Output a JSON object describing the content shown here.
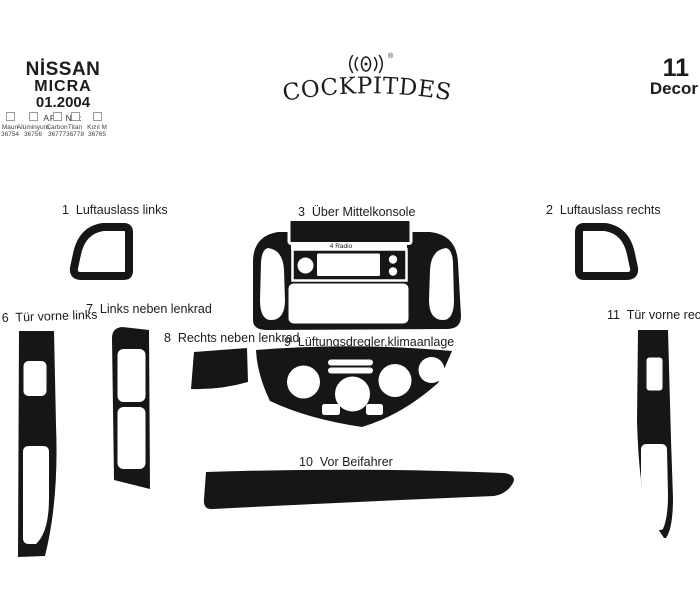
{
  "header": {
    "brand": {
      "make": "NİSSAN",
      "model": "MICRA",
      "date": "01.2004",
      "art_label": "ART NR:",
      "finishes": [
        {
          "name": "Maun",
          "number": "36754"
        },
        {
          "name": "Alüminyum",
          "number": "36756"
        },
        {
          "name": "Carbon",
          "number": "36777"
        },
        {
          "name": "Titan",
          "number": "36778"
        },
        {
          "name": "Kızıl M",
          "number": "36765"
        }
      ]
    },
    "logo": {
      "text": "COCKPITDESIGN",
      "registered": "®"
    },
    "decor": {
      "count": "11",
      "label": "Decor"
    }
  },
  "pieces": [
    {
      "num": "1",
      "label": "1  Luftauslass links"
    },
    {
      "num": "2",
      "label": "2  Luftauslass rechts"
    },
    {
      "num": "3",
      "label": "3  Über Mittelkonsole"
    },
    {
      "num": "4",
      "label": "4 Radio"
    },
    {
      "num": "5",
      "label": "5  Mittelkonsole"
    },
    {
      "num": "6",
      "label": "6  Tür vorne links"
    },
    {
      "num": "7",
      "label": "7  Links neben lenkrad"
    },
    {
      "num": "8",
      "label": "8  Rechts neben lenkrad"
    },
    {
      "num": "9",
      "label": "9  Lüftungsdregler,klimaanlage"
    },
    {
      "num": "10",
      "label": "10  Vor Beifahrer"
    },
    {
      "num": "11",
      "label": "11  Tür vorne rechts"
    }
  ],
  "colors": {
    "ink": "#161616",
    "background": "#ffffff"
  }
}
